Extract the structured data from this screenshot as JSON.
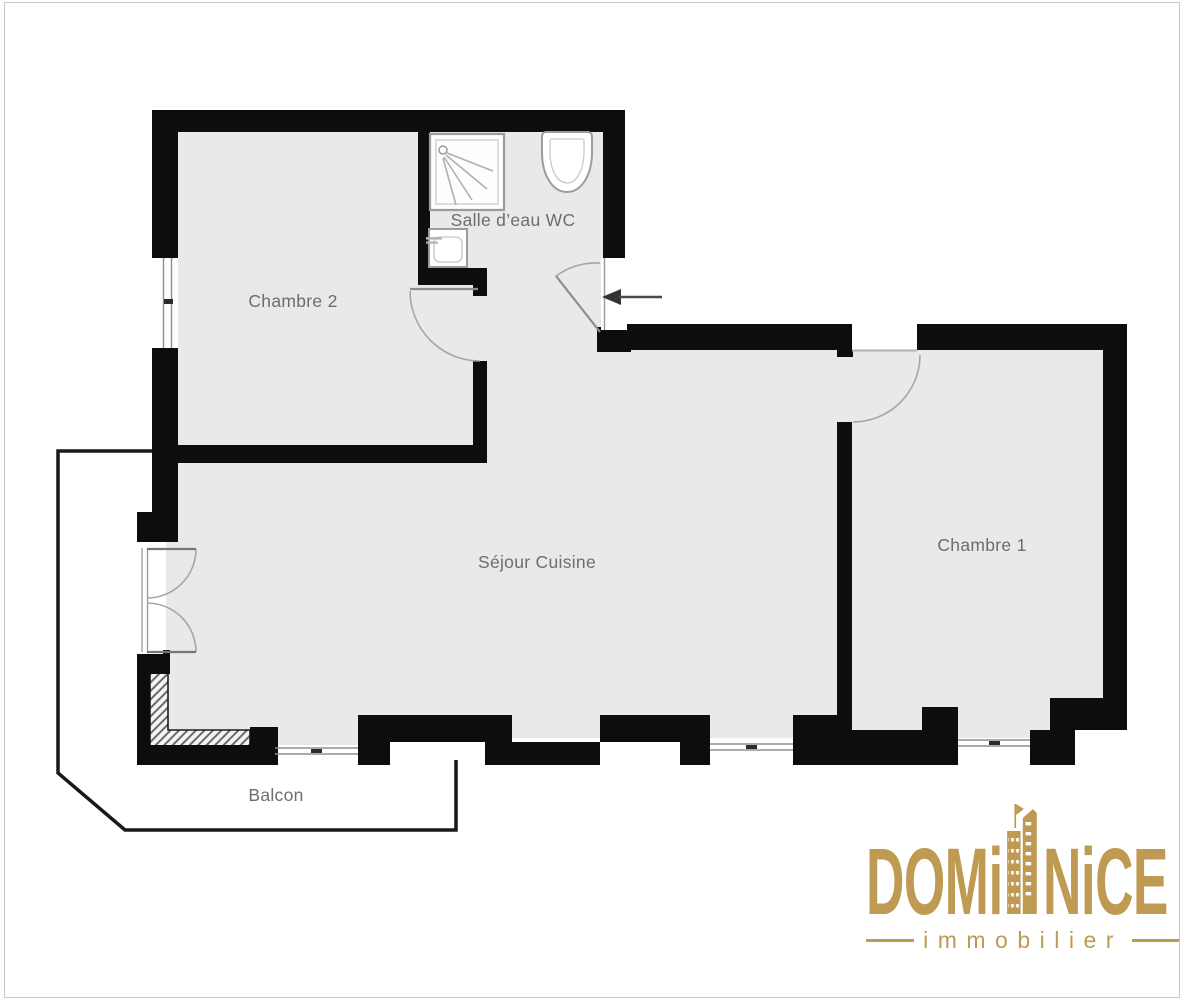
{
  "floor_plan": {
    "rooms": [
      {
        "id": "chambre-2",
        "label": "Chambre 2"
      },
      {
        "id": "salle-deau-wc",
        "label": "Salle d’eau WC"
      },
      {
        "id": "sejour-cuisine",
        "label": "Séjour Cuisine"
      },
      {
        "id": "chambre-1",
        "label": "Chambre 1"
      },
      {
        "id": "balcon",
        "label": "Balcon"
      }
    ],
    "features": {
      "entrance_arrow": "left-pointing arrow at entrance door",
      "windows": 4,
      "door_swings": 5,
      "fixtures": [
        "shower",
        "washbasin",
        "toilet"
      ]
    },
    "colors": {
      "floor_fill": "#e9e9e9",
      "walls": "#0d0d0d",
      "room_label": "#6d6d6d",
      "swing_arc": "#a6a6a6",
      "balcony_outline": "#191919"
    }
  },
  "logo": {
    "brand_left": "DOM",
    "brand_i": "i",
    "brand_right": "NiCE",
    "tagline": "immobilier",
    "gold": "#bf9a52"
  }
}
